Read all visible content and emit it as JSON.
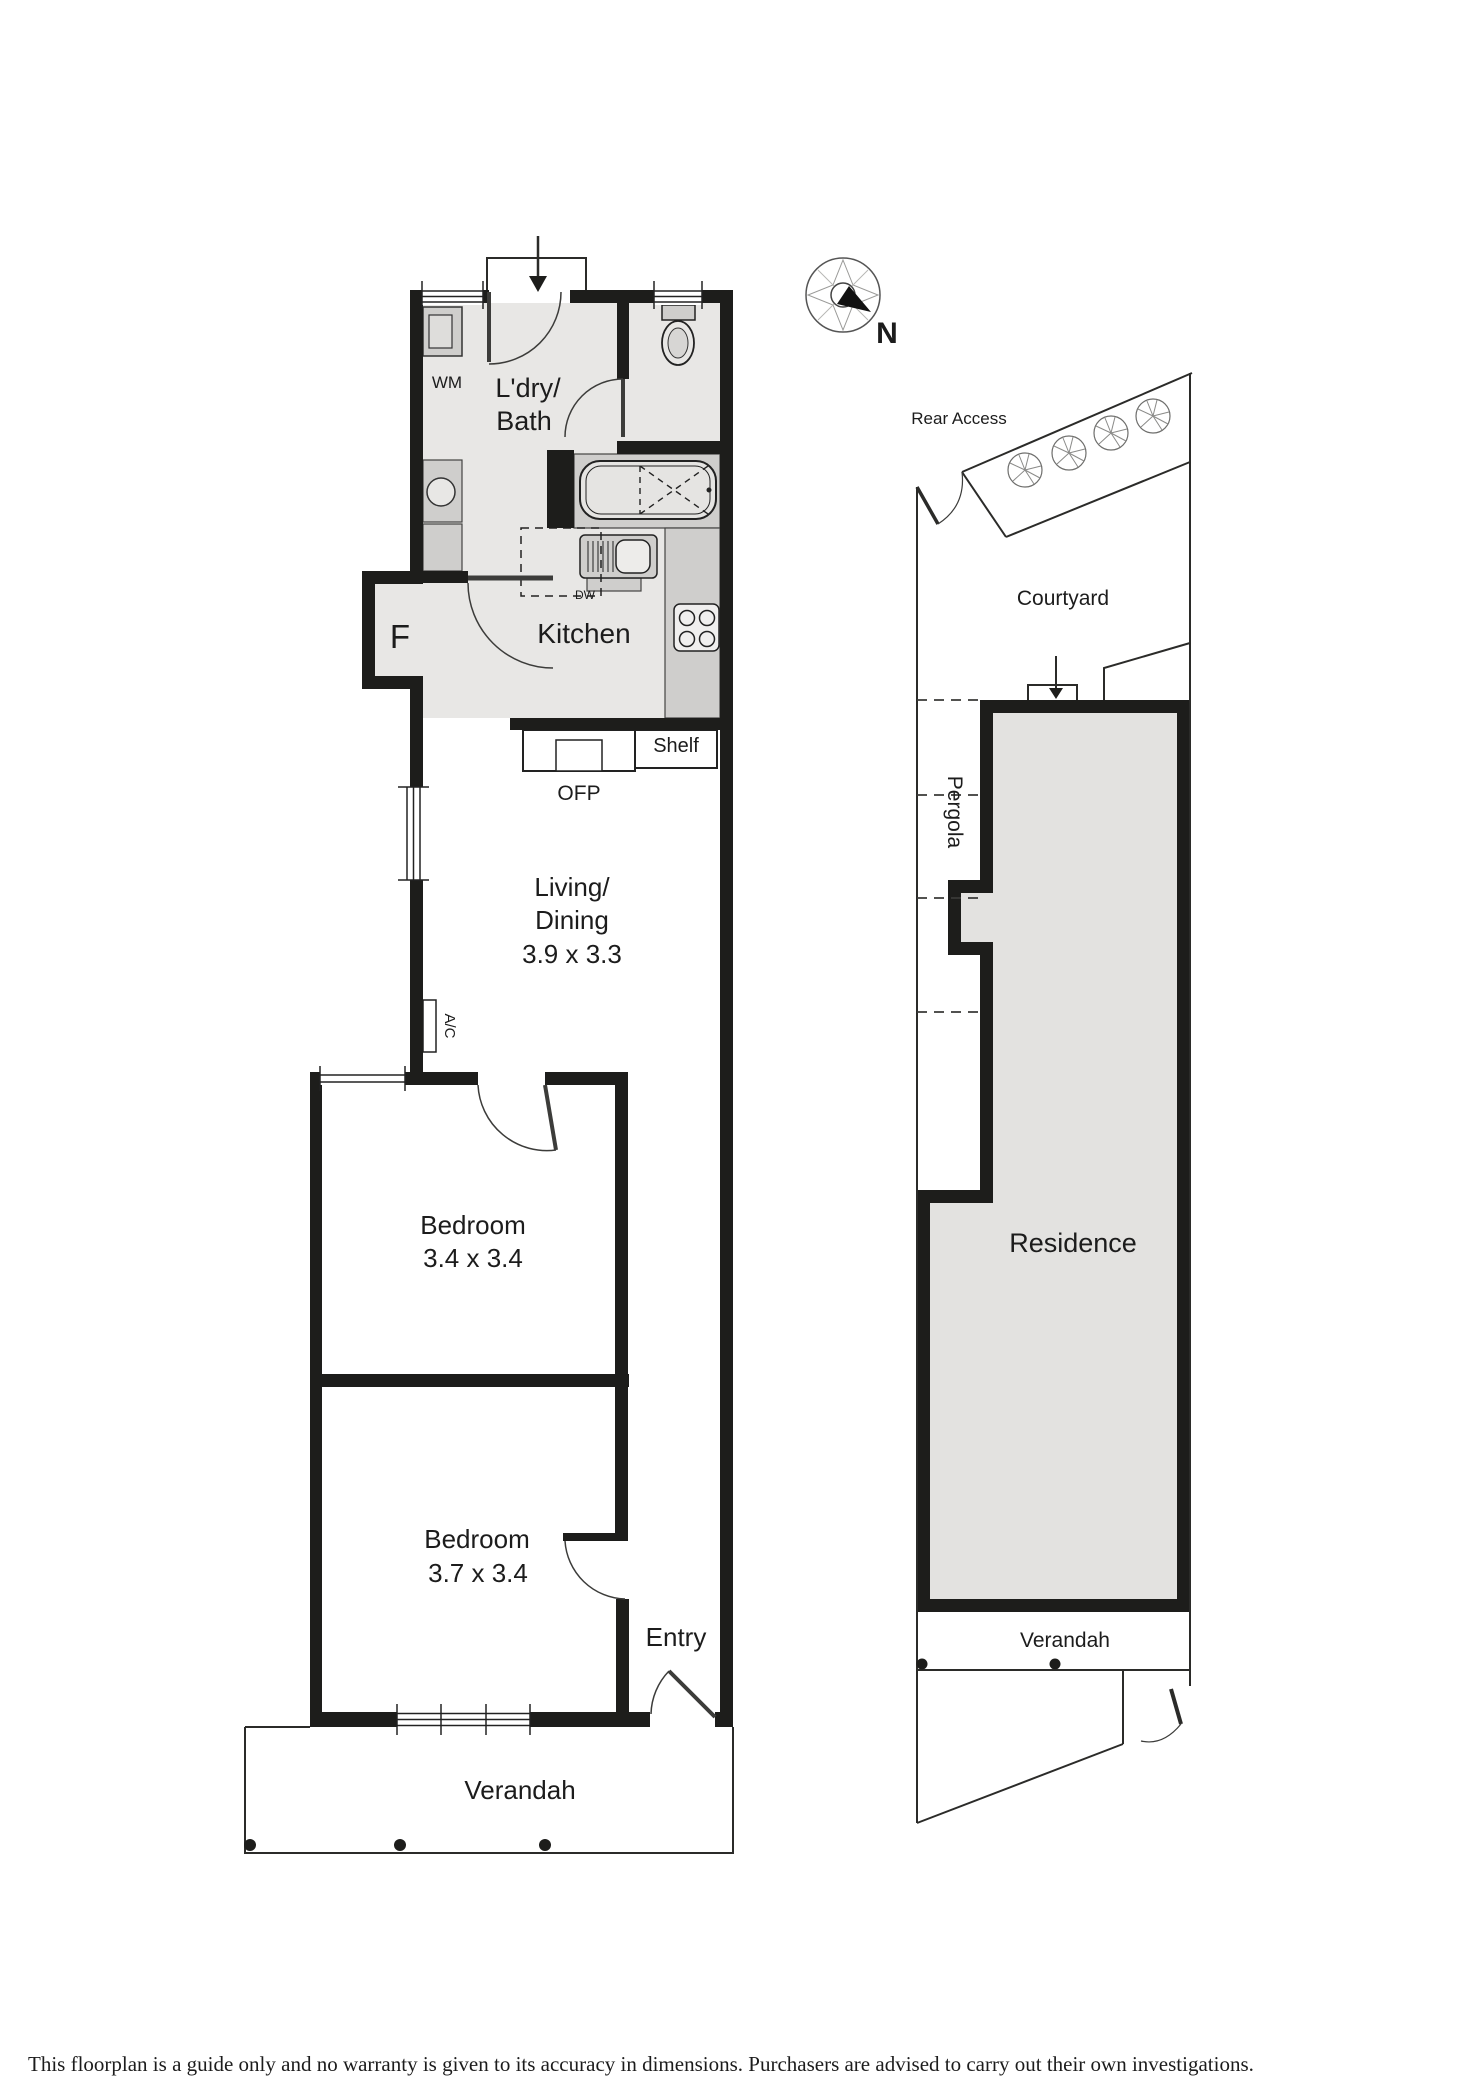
{
  "floorplan": {
    "laundry_bath": {
      "line1": "L'dry/",
      "line2": "Bath"
    },
    "living_dining": {
      "line1": "Living/",
      "line2": "Dining",
      "dims": "3.9 x 3.3"
    },
    "bedroom1": {
      "name": "Bedroom",
      "dims": "3.4 x 3.4"
    },
    "bedroom2": {
      "name": "Bedroom",
      "dims": "3.7 x 3.4"
    },
    "labels": {
      "wm": "WM",
      "fridge": "F",
      "kitchen": "Kitchen",
      "dishwasher": "DW",
      "shelf": "Shelf",
      "fireplace": "OFP",
      "ac": "A/C",
      "entry": "Entry",
      "verandah": "Verandah"
    }
  },
  "site": {
    "rear_access": "Rear Access",
    "courtyard": "Courtyard",
    "pergola": "Pergola",
    "residence": "Residence",
    "verandah": "Verandah"
  },
  "compass": {
    "north": "N"
  },
  "footer": {
    "disclaimer": "This floorplan is a guide only and no warranty is given to its accuracy in dimensions. Purchasers are advised to carry out their own investigations."
  },
  "colors": {
    "wall": "#1d1d1b",
    "floor": "#e8e7e5",
    "counter": "#cfcecc",
    "residence_fill": "#e3e2e0",
    "line": "#2b2b29",
    "background": "#ffffff"
  }
}
